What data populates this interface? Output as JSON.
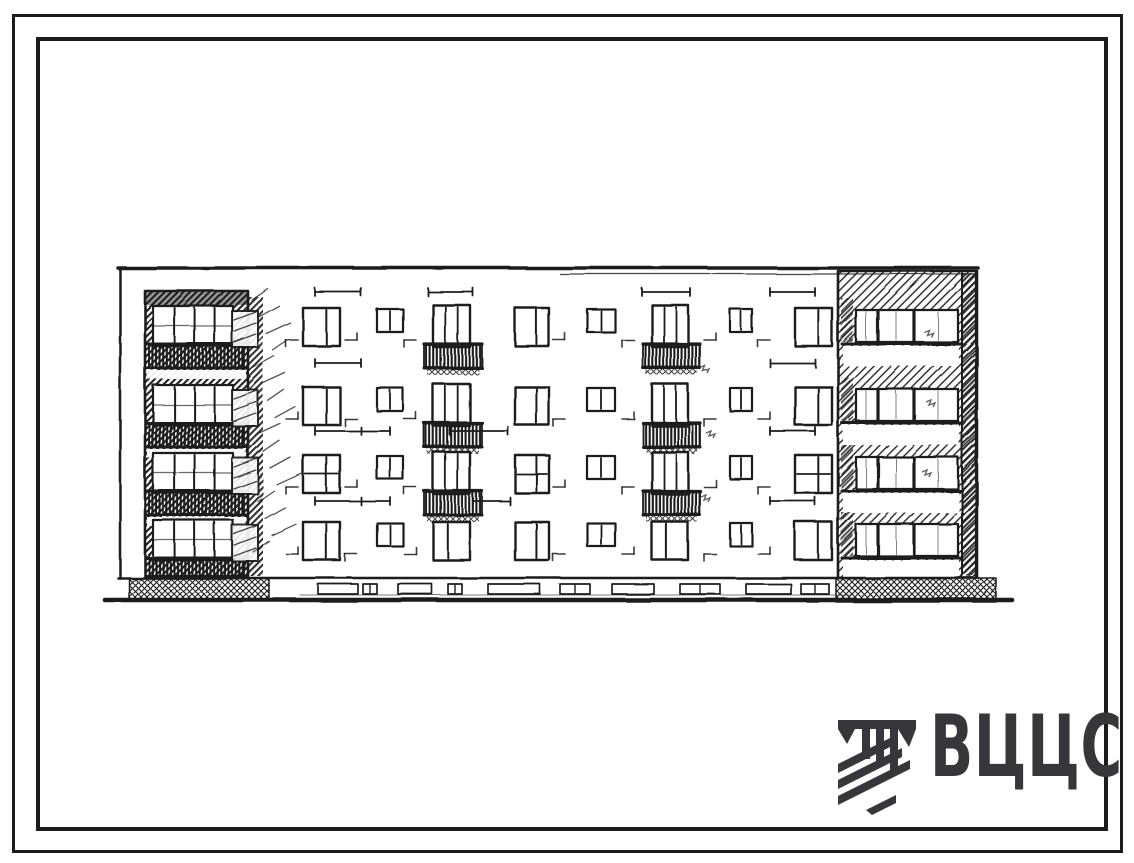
{
  "colors": {
    "ink": "#1b1b1d",
    "paper": "#ffffff",
    "logo": "#36363b"
  },
  "logo": {
    "text": "ВЦЦС",
    "icon": "vcis-emblem-icon"
  },
  "drawing": {
    "title": "four-storey-building-facade-elevation",
    "floors": 4,
    "rows": [
      308,
      387,
      455,
      522
    ],
    "outline": {
      "x1": 118,
      "x2": 978,
      "top": 268,
      "thin": [
        560,
        975,
        274
      ],
      "leftX": 120,
      "rightX": 976,
      "bottom": 578
    },
    "tower": {
      "x": 145,
      "y": 291,
      "w": 103,
      "h": 287,
      "winX": 153,
      "winW": 80,
      "mullions": [
        0.27,
        0.52,
        0.77
      ]
    },
    "shadow": {
      "x": 248,
      "w": 15
    },
    "columns": [
      {
        "t": "sketch",
        "x": 232,
        "w": 26
      },
      {
        "t": "big",
        "x": 303,
        "w": 37
      },
      {
        "t": "small",
        "x": 377,
        "w": 26
      },
      {
        "t": "balc",
        "x": 433,
        "w": 37
      },
      {
        "t": "big",
        "x": 515,
        "w": 34
      },
      {
        "t": "small",
        "x": 587,
        "w": 28
      },
      {
        "t": "balc",
        "x": 652,
        "w": 36
      },
      {
        "t": "small",
        "x": 730,
        "w": 22
      },
      {
        "t": "big",
        "x": 795,
        "w": 37
      }
    ],
    "bay": {
      "x": 838,
      "y": 271,
      "w": 139,
      "h": 307,
      "edge": 15,
      "winX": 856,
      "winW": 102,
      "mull": [
        22,
        58
      ]
    },
    "ground": {
      "wallY": 578,
      "groundY": 600,
      "x1": 105,
      "x2": 1012,
      "blocks": [
        [
          129,
          578,
          140,
          23
        ],
        [
          836,
          578,
          160,
          24
        ]
      ],
      "cellar": [
        [
          318,
          40
        ],
        [
          363,
          14
        ],
        [
          398,
          34
        ],
        [
          448,
          14
        ],
        [
          488,
          52
        ],
        [
          560,
          30
        ],
        [
          612,
          42
        ],
        [
          680,
          40
        ],
        [
          746,
          45
        ],
        [
          801,
          28
        ]
      ]
    },
    "ticks": [
      [
        315,
        361,
        292
      ],
      [
        428,
        473,
        292
      ],
      [
        642,
        690,
        292
      ],
      [
        770,
        815,
        292
      ],
      [
        315,
        361,
        363
      ],
      [
        770,
        815,
        363
      ],
      [
        315,
        390,
        431,
        361
      ],
      [
        450,
        508,
        431
      ],
      [
        770,
        815,
        431
      ],
      [
        315,
        390,
        501,
        361
      ],
      [
        473,
        510,
        501
      ],
      [
        770,
        815,
        501
      ]
    ],
    "sillXs": [
      286,
      345,
      404,
      553,
      622,
      704,
      758
    ],
    "smudges": [
      [
        700,
        368
      ],
      [
        706,
        433
      ],
      [
        701,
        497
      ],
      [
        924,
        332
      ],
      [
        926,
        402
      ],
      [
        922,
        472
      ]
    ],
    "scribbleBand": {
      "x": 252,
      "y": 300,
      "n": 16
    }
  }
}
